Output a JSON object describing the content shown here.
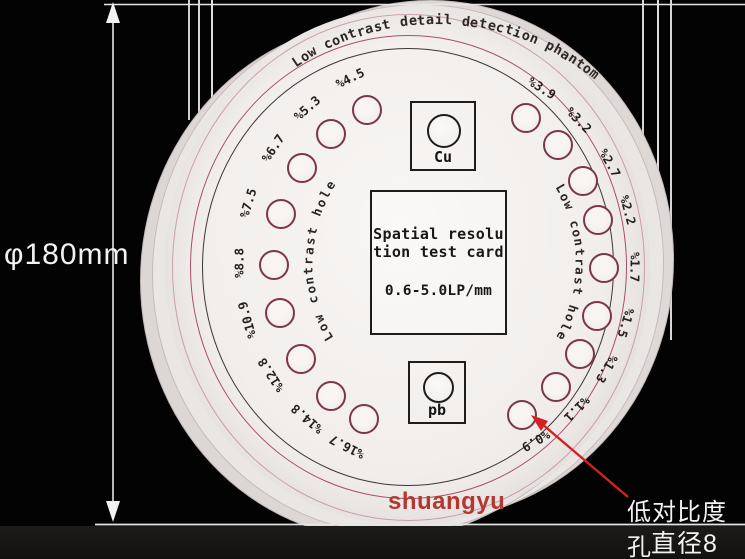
{
  "phantom": {
    "title_arc": "Low contrast detail detection phantom",
    "left_arc_label": "Low contrast hole",
    "right_arc_label": "Low contrast hole",
    "center_card": {
      "line1": "Spatial resolu",
      "line2": "tion test card",
      "line3": "0.6-5.0LP/mm"
    },
    "cu_insert_label": "Cu",
    "pb_insert_label": "pb",
    "brand": "shuangyu",
    "holes": [
      {
        "label": "%4.5",
        "angle": -116
      },
      {
        "label": "%5.3",
        "angle": -131
      },
      {
        "label": "%6.7",
        "angle": -146
      },
      {
        "label": "%7.5",
        "angle": -163
      },
      {
        "label": "%8.8",
        "angle": 180
      },
      {
        "label": "%10.9",
        "angle": 164
      },
      {
        "label": "%12.8",
        "angle": 147
      },
      {
        "label": "%14.8",
        "angle": 131
      },
      {
        "label": "%16.7",
        "angle": 117
      },
      {
        "label": "%3.9",
        "angle": -58
      },
      {
        "label": "%3.2",
        "angle": -44
      },
      {
        "label": "%2.7",
        "angle": -29
      },
      {
        "label": "%2.2",
        "angle": -15
      },
      {
        "label": "%1.7",
        "angle": 1
      },
      {
        "label": "%1.5",
        "angle": 17
      },
      {
        "label": "%1.3",
        "angle": 31
      },
      {
        "label": "%1.1",
        "angle": 45
      },
      {
        "label": "%0.9",
        "angle": 60
      }
    ]
  },
  "annotations": {
    "diameter_label": "φ180mm",
    "callout_line1": "低对比度孔",
    "callout_line2": "直径8"
  },
  "colors": {
    "ring_red": "#aa4f66",
    "ring_dark": "#3f363a",
    "hole_outline": "#7d3649",
    "arrow_red": "#d42020",
    "brand_red": "#b23831",
    "dimension_white": "#e8e8e8"
  }
}
